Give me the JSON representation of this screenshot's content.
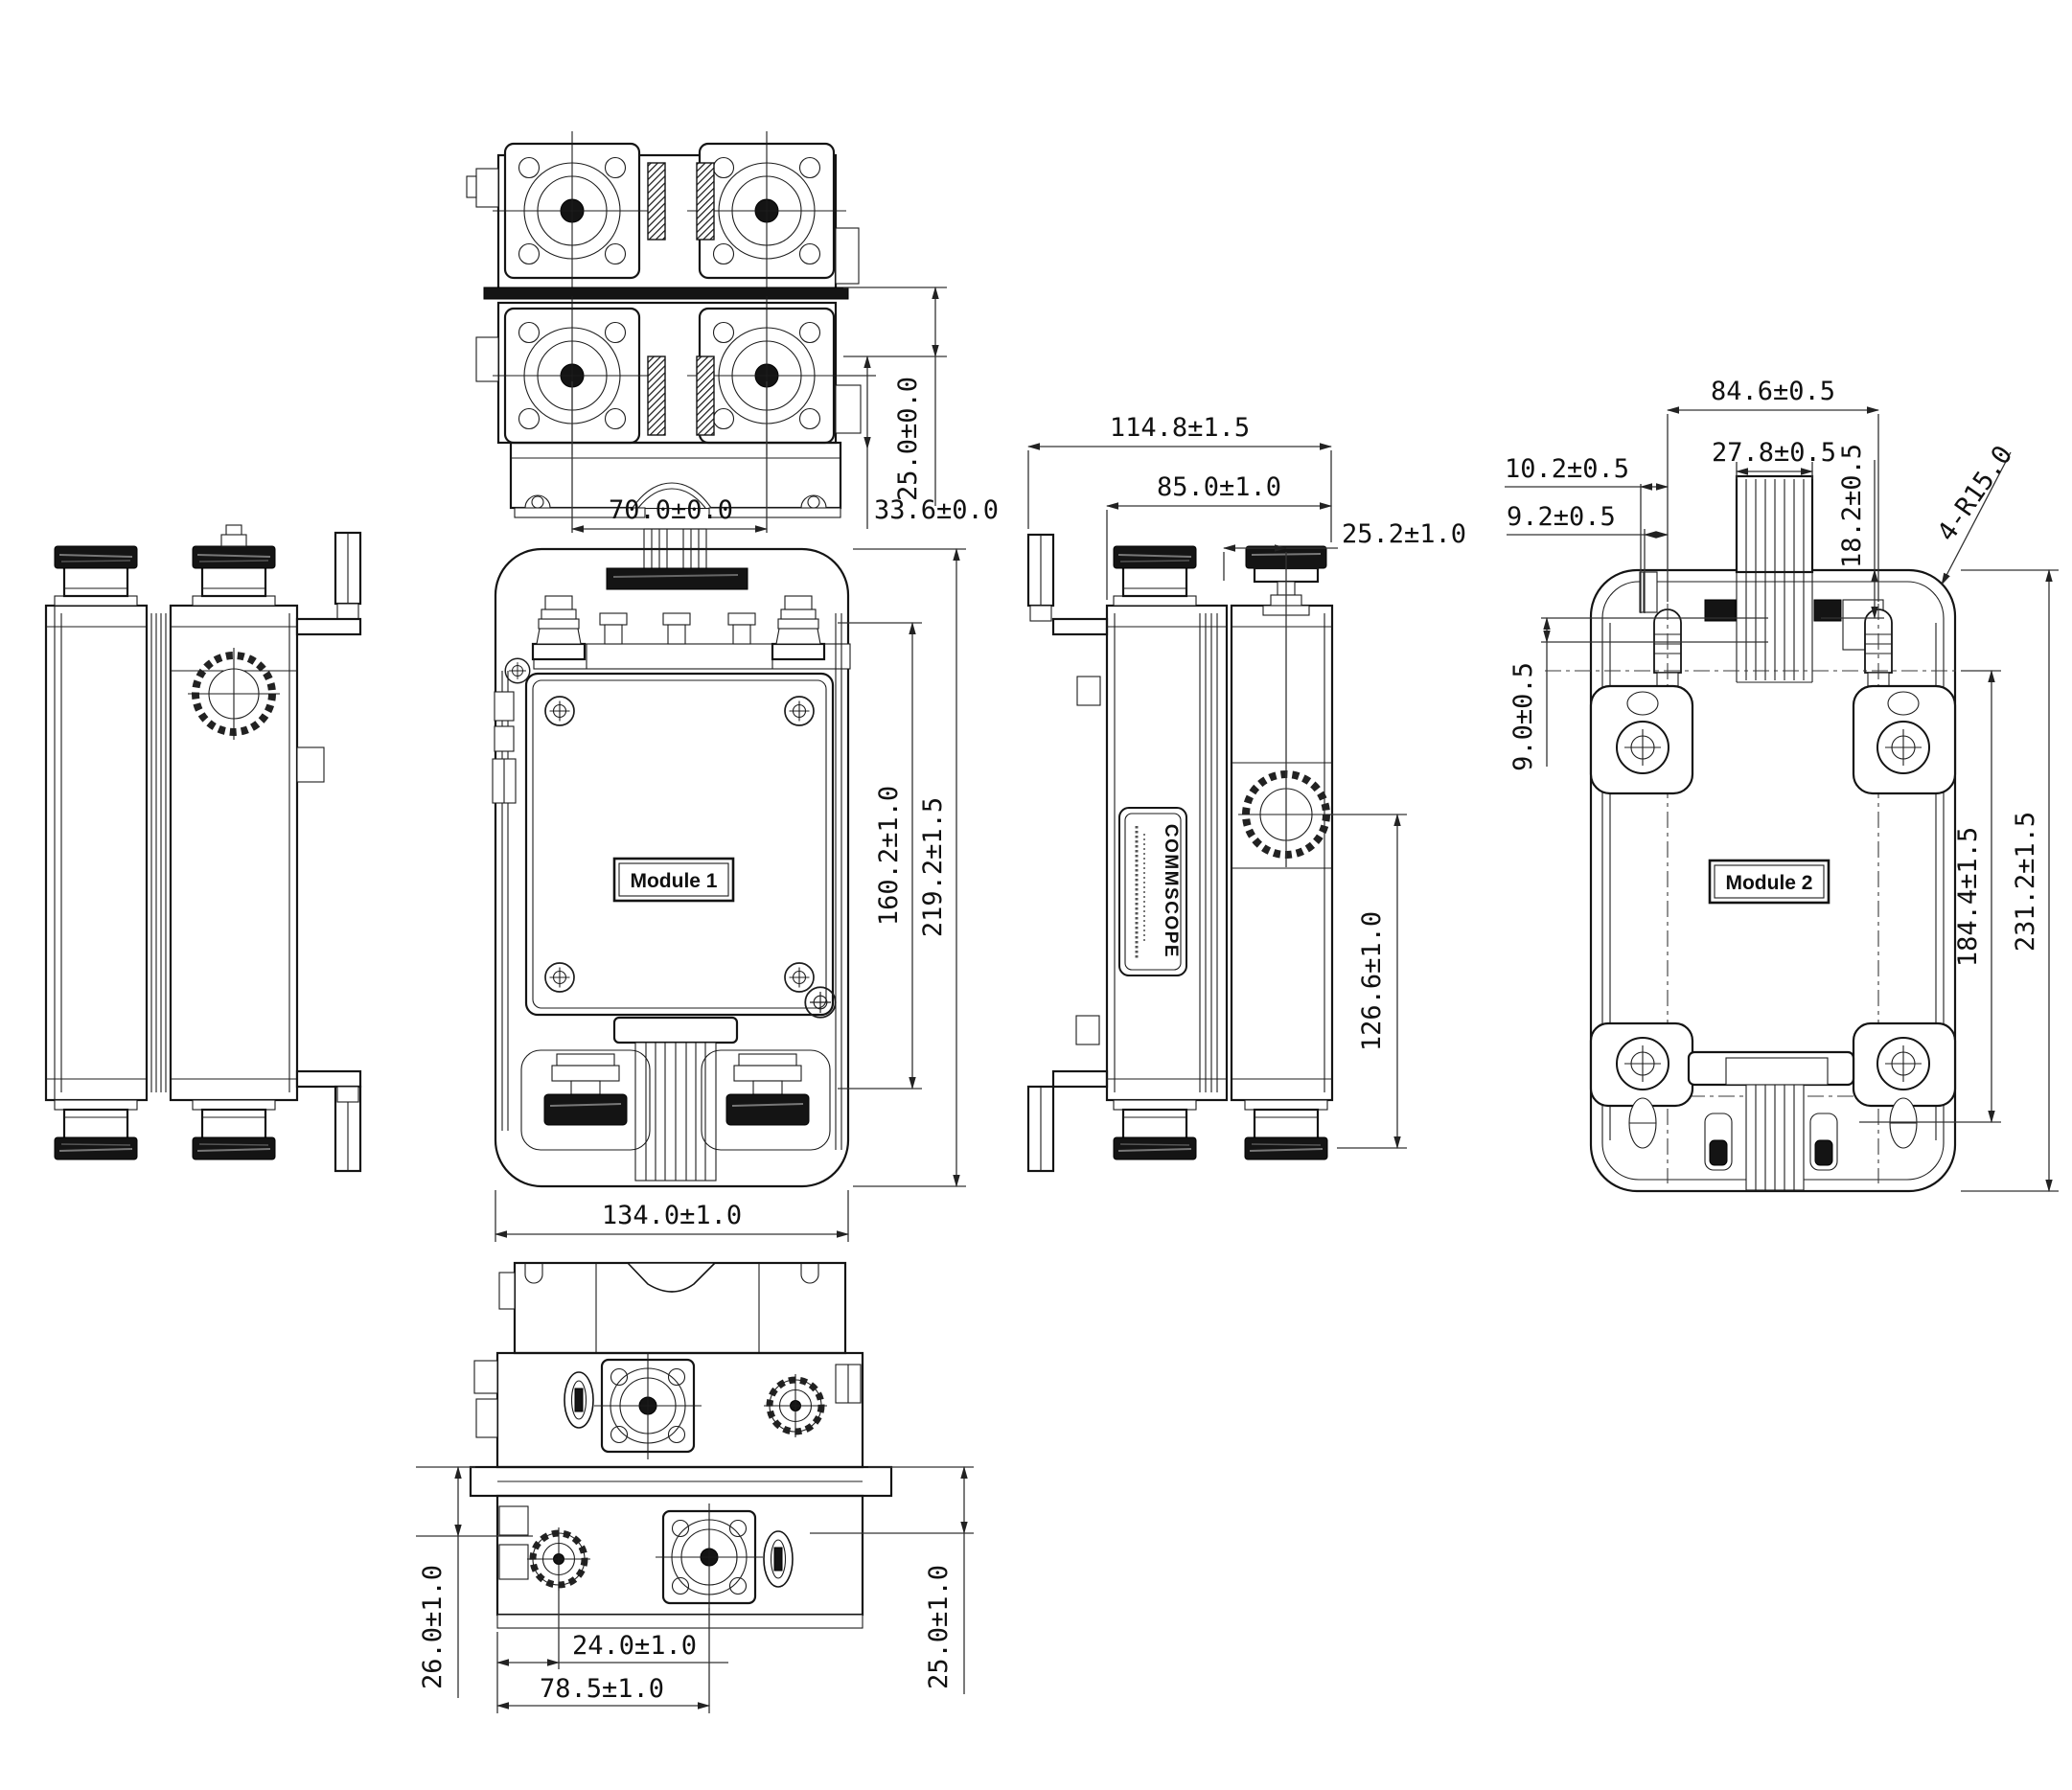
{
  "drawing": {
    "background": "#ffffff",
    "line_color": "#141414",
    "dim_color": "#333333"
  },
  "top_view": {
    "dim_connector_spacing": "70.0±0.0",
    "dim_row_offset": "25.0±0.0",
    "dim_bracket_offset": "33.6±0.0"
  },
  "front_view": {
    "module_label": "Module 1",
    "dim_body_height": "160.2±1.0",
    "dim_overall_height": "219.2±1.5",
    "dim_overall_width": "134.0±1.0"
  },
  "side_view": {
    "brand_label": "COMMSCOPE",
    "dim_overall_depth": "114.8±1.5",
    "dim_body_depth": "85.0±1.0",
    "dim_connector_offset": "25.2±1.0",
    "dim_body_height": "126.6±1.0"
  },
  "rear_view": {
    "module_label": "Module 2",
    "dim_bolt_spacing": "84.6±0.5",
    "dim_gland_width": "27.8±0.5",
    "dim_gland_offset": "18.2±0.5",
    "dim_slot_offset_a": "10.2±0.5",
    "dim_slot_offset_b": "9.2±0.5",
    "dim_corner_radius": "4-R15.0",
    "dim_bracket_offset": "9.0±0.5",
    "dim_mount_height": "184.4±1.5",
    "dim_overall_height": "231.2±1.5"
  },
  "bottom_view": {
    "dim_left_port_offset": "26.0±1.0",
    "dim_edge_to_port": "24.0±1.0",
    "dim_port_spacing": "78.5±1.0",
    "dim_right_port_offset": "25.0±1.0"
  }
}
